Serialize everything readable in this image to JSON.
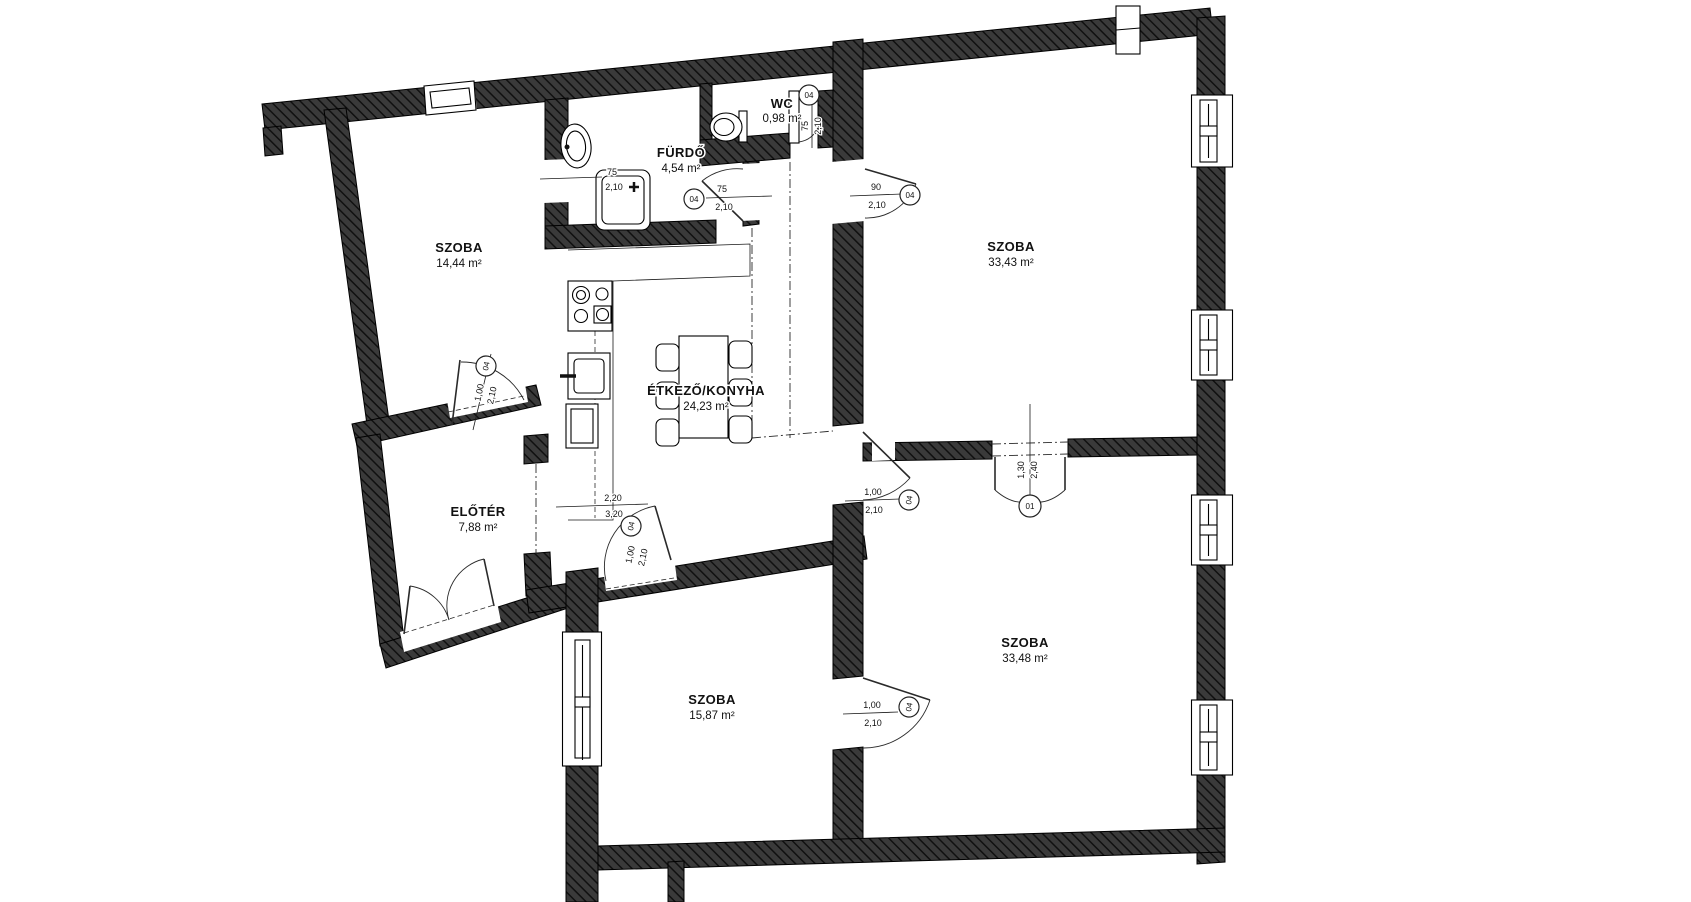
{
  "plan": {
    "rooms": [
      {
        "id": "szoba-1",
        "name": "SZOBA",
        "area": "14,44 m²"
      },
      {
        "id": "furdo",
        "name": "FÜRDŐ",
        "area": "4,54 m²"
      },
      {
        "id": "wc",
        "name": "WC",
        "area": "0,98 m²"
      },
      {
        "id": "szoba-2",
        "name": "SZOBA",
        "area": "33,43 m²"
      },
      {
        "id": "etkezo-konyha",
        "name": "ÉTKEZŐ/KONYHA",
        "area": "24,23 m²"
      },
      {
        "id": "eloter",
        "name": "ELŐTÉR",
        "area": "7,88 m²"
      },
      {
        "id": "szoba-3",
        "name": "SZOBA",
        "area": "15,87 m²"
      },
      {
        "id": "szoba-4",
        "name": "SZOBA",
        "area": "33,48 m²"
      }
    ],
    "doors": [
      {
        "tag": "04",
        "w": "1,00",
        "h": "2,10"
      },
      {
        "tag": "",
        "w": "75",
        "h": "2,10"
      },
      {
        "tag": "04",
        "w": "75",
        "h": "2,10"
      },
      {
        "tag": "04",
        "w": "75",
        "h": "2,10"
      },
      {
        "tag": "04",
        "w": "90",
        "h": "2,10"
      },
      {
        "tag": "04",
        "w": "1,00",
        "h": "2,10"
      },
      {
        "tag": "04",
        "w": "1,00",
        "h": "2,10"
      },
      {
        "tag": "04",
        "w": "1,00",
        "h": "2,10"
      },
      {
        "tag": "01",
        "w": "1,30",
        "h": "2,40"
      }
    ],
    "opening": {
      "w": "2,20",
      "h": "3,20"
    },
    "colors": {
      "wall": "#3a3a3a",
      "hatch": "#101010",
      "line": "#000000",
      "bg": "#ffffff"
    }
  }
}
